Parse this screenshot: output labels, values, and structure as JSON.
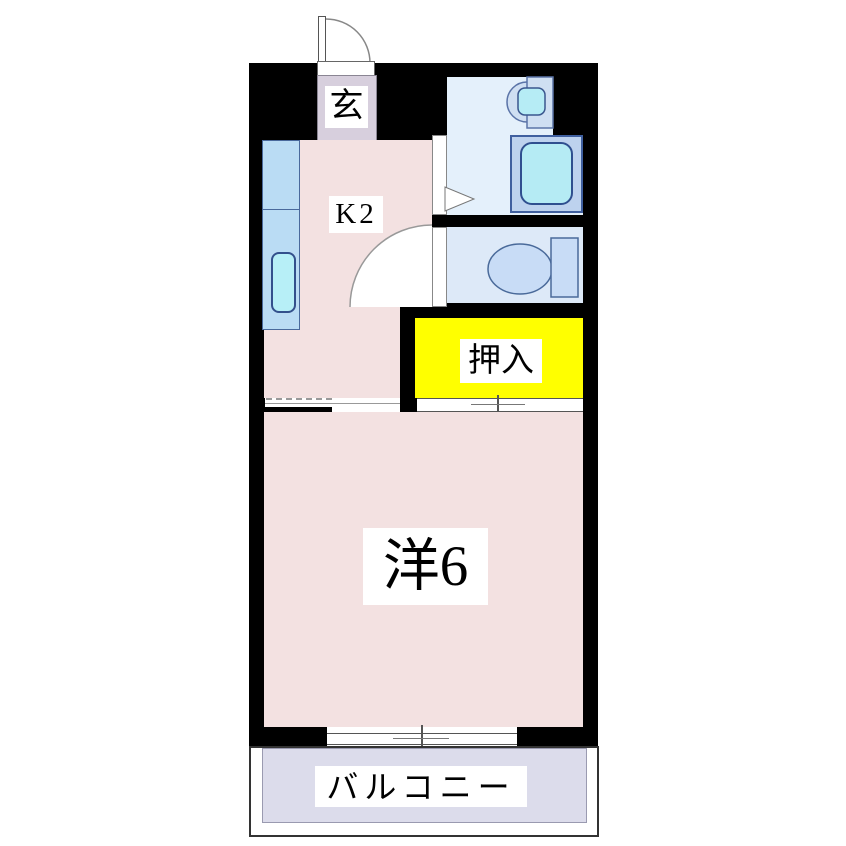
{
  "plan": {
    "title": "1K apartment floor plan",
    "labels": {
      "entrance": "玄",
      "kitchen": "K2",
      "closet": "押入",
      "western_room": "洋6",
      "balcony": "バルコニー"
    },
    "colors": {
      "wall": "#000000",
      "room_pink": "#f3e1e1",
      "entrance_lavender": "#d7cfdd",
      "washroom_blue": "#e4f0fb",
      "toilet_blue": "#dde9f8",
      "fixture_blue": "#bdd2ee",
      "fixture_cyan": "#b5ebf4",
      "closet_yellow": "#ffff00",
      "balcony_lavender": "#dcdceb"
    }
  }
}
